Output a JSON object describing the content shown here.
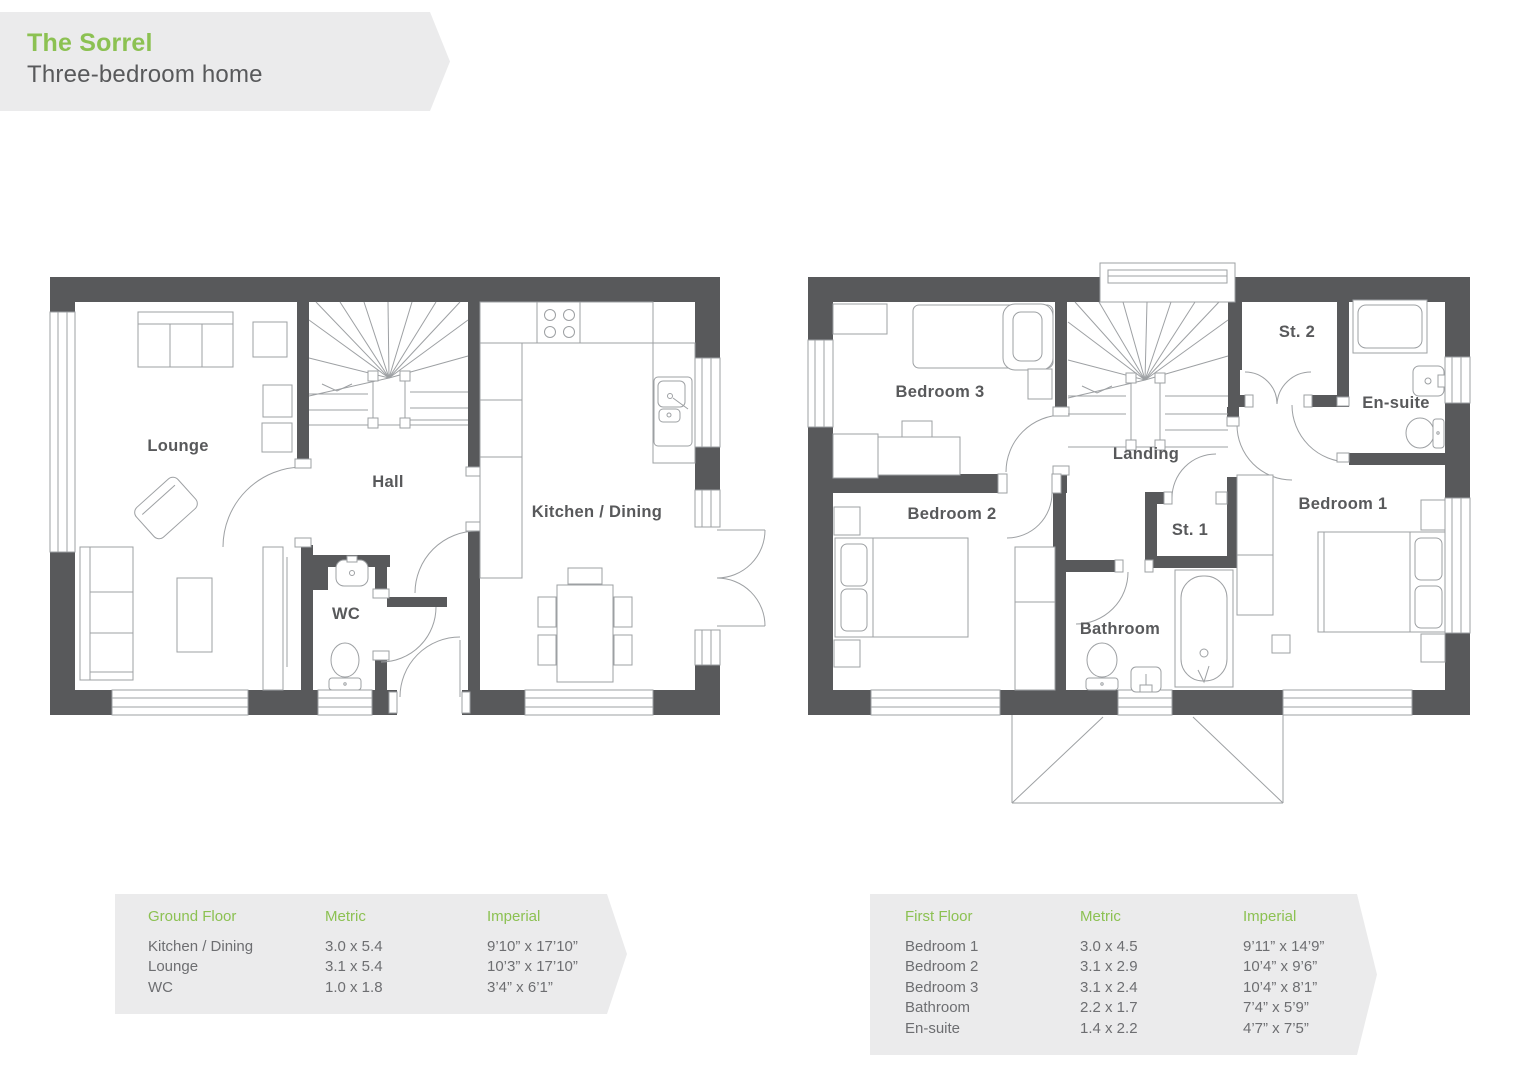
{
  "header": {
    "title": "The Sorrel",
    "subtitle": "Three-bedroom home"
  },
  "colors": {
    "accent_green": "#8CC152",
    "wall_gray": "#58595B",
    "panel_gray": "#EBEBEC",
    "plan_line_gray": "#9DA0A3",
    "table_text_gray": "#6D6E71"
  },
  "ground_floor": {
    "name": "Ground Floor",
    "rooms": {
      "lounge": "Lounge",
      "hall": "Hall",
      "wc": "WC",
      "kitchen_dining": "Kitchen / Dining"
    }
  },
  "first_floor": {
    "name": "First Floor",
    "rooms": {
      "bedroom3": "Bedroom 3",
      "bedroom2": "Bedroom 2",
      "landing": "Landing",
      "st1": "St. 1",
      "st2": "St. 2",
      "ensuite": "En-suite",
      "bathroom": "Bathroom",
      "bedroom1": "Bedroom 1"
    }
  },
  "tables": {
    "ground": {
      "title": "Ground Floor",
      "metric_header": "Metric",
      "imperial_header": "Imperial",
      "rows": [
        {
          "room": "Kitchen / Dining",
          "metric": "3.0 x 5.4",
          "imperial": "9’10” x 17’10”"
        },
        {
          "room": "Lounge",
          "metric": "3.1 x 5.4",
          "imperial": "10’3” x 17’10”"
        },
        {
          "room": "WC",
          "metric": "1.0 x 1.8",
          "imperial": "3’4” x 6’1”"
        }
      ]
    },
    "first": {
      "title": "First Floor",
      "metric_header": "Metric",
      "imperial_header": "Imperial",
      "rows": [
        {
          "room": "Bedroom 1",
          "metric": "3.0 x 4.5",
          "imperial": "9’11” x 14’9”"
        },
        {
          "room": "Bedroom 2",
          "metric": "3.1 x 2.9",
          "imperial": "10’4” x 9’6”"
        },
        {
          "room": "Bedroom 3",
          "metric": "3.1 x 2.4",
          "imperial": "10’4” x 8’1”"
        },
        {
          "room": "Bathroom",
          "metric": "2.2 x 1.7",
          "imperial": "7’4” x 5’9”"
        },
        {
          "room": "En-suite",
          "metric": "1.4 x 2.2",
          "imperial": "4’7” x 7’5”"
        }
      ]
    }
  }
}
